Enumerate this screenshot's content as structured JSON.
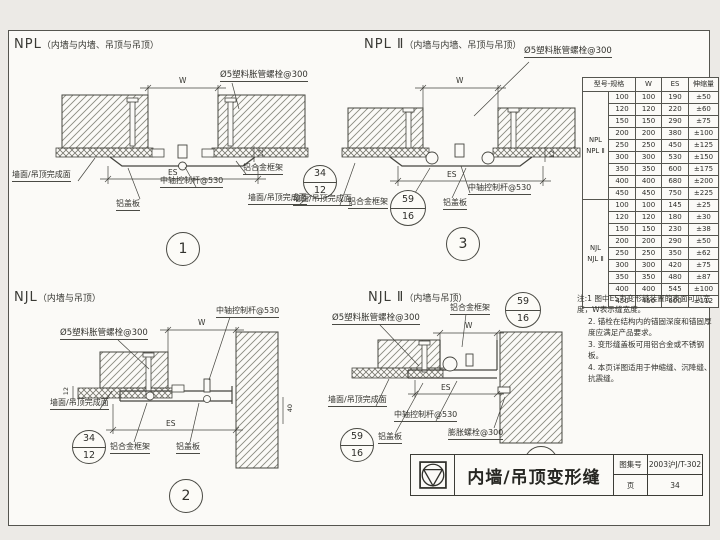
{
  "panels": {
    "p1": {
      "code": "NPL",
      "scope": "（内墙与内墙、吊顶与吊顶）",
      "number": "1",
      "bolt_callout": "Ø5塑料胀管螺栓@300",
      "dim_w": "W",
      "dim_es": "ES",
      "dim_side": "12",
      "finish_left": "墙面/吊顶完成面",
      "finish_right": "墙面/吊顶完成面",
      "control_rod": "中轴控制杆@530",
      "cover_plate": "铝盖板",
      "frame": "铝合金框架",
      "ref_top": "34",
      "ref_bottom": "12"
    },
    "p2": {
      "code": "NJL",
      "scope": "（内墙与吊顶）",
      "number": "2",
      "bolt_callout": "Ø5塑料胀管螺栓@300",
      "dim_w": "W",
      "dim_es": "ES",
      "dim_side": "40",
      "dim_side2": "12",
      "finish": "墙面/吊顶完成面",
      "control_rod": "中轴控制杆@530",
      "cover_plate": "铝盖板",
      "frame": "铝合金框架",
      "ref_top": "34",
      "ref_bottom": "12"
    },
    "p3": {
      "code": "NPL Ⅱ",
      "scope": "（内墙与内墙、吊顶与吊顶）",
      "number": "3",
      "bolt_callout": "Ø5塑料胀管螺栓@300",
      "dim_w": "W",
      "dim_es": "ES",
      "dim_side": "12",
      "finish": "墙面/吊顶完成面",
      "control_rod": "中轴控制杆@530",
      "cover_plate": "铝盖板",
      "frame": "铝合金框架",
      "ref_top": "59",
      "ref_bottom": "16"
    },
    "p4": {
      "code": "NJL Ⅱ",
      "scope": "（内墙与吊顶）",
      "number": "4",
      "bolt_callout": "Ø5塑料胀管螺栓@300",
      "anchor_callout": "膨胀螺栓@300",
      "dim_w": "W",
      "dim_es": "ES",
      "finish": "墙面/吊顶完成面",
      "control_rod": "中轴控制杆@530",
      "cover_plate": "铝盖板",
      "frame": "铝合金框架",
      "ref_frame_top": "59",
      "ref_frame_bottom": "16",
      "ref_cover_top": "59",
      "ref_cover_bottom": "16"
    }
  },
  "table": {
    "headers": [
      "型号-规格",
      "W",
      "ES",
      "伸缩量"
    ],
    "groups": [
      {
        "label": "NPL\nNPL Ⅱ",
        "rows": [
          [
            "100",
            "100",
            "190",
            "±50"
          ],
          [
            "120",
            "120",
            "220",
            "±60"
          ],
          [
            "150",
            "150",
            "290",
            "±75"
          ],
          [
            "200",
            "200",
            "380",
            "±100"
          ],
          [
            "250",
            "250",
            "450",
            "±125"
          ],
          [
            "300",
            "300",
            "530",
            "±150"
          ],
          [
            "350",
            "350",
            "600",
            "±175"
          ],
          [
            "400",
            "400",
            "680",
            "±200"
          ],
          [
            "450",
            "450",
            "750",
            "±225"
          ]
        ]
      },
      {
        "label": "NJL\nNJL Ⅱ",
        "rows": [
          [
            "100",
            "100",
            "145",
            "±25"
          ],
          [
            "120",
            "120",
            "180",
            "±30"
          ],
          [
            "150",
            "150",
            "230",
            "±38"
          ],
          [
            "200",
            "200",
            "290",
            "±50"
          ],
          [
            "250",
            "250",
            "350",
            "±62"
          ],
          [
            "300",
            "300",
            "420",
            "±75"
          ],
          [
            "350",
            "350",
            "480",
            "±87"
          ],
          [
            "400",
            "400",
            "545",
            "±100"
          ],
          [
            "450",
            "450",
            "600",
            "±112"
          ]
        ]
      }
    ]
  },
  "notes": {
    "lines": [
      "注:1 图中ES为变形缝装置的表面可见宽度，W表示缝宽度。",
      "2. 锚栓在结构内的锚固深度和锚固厚度应满足产品要求。",
      "3. 变形缝盖板可用铝合金或不锈钢板。",
      "4. 本页详图适用于伸缩缝、沉降缝、抗震缝。"
    ]
  },
  "title_block": {
    "title": "内墙/吊顶变形缝",
    "atlas_no_label": "图集号",
    "atlas_no": "2003沪J/T-302",
    "page_label": "页",
    "page": "34"
  }
}
